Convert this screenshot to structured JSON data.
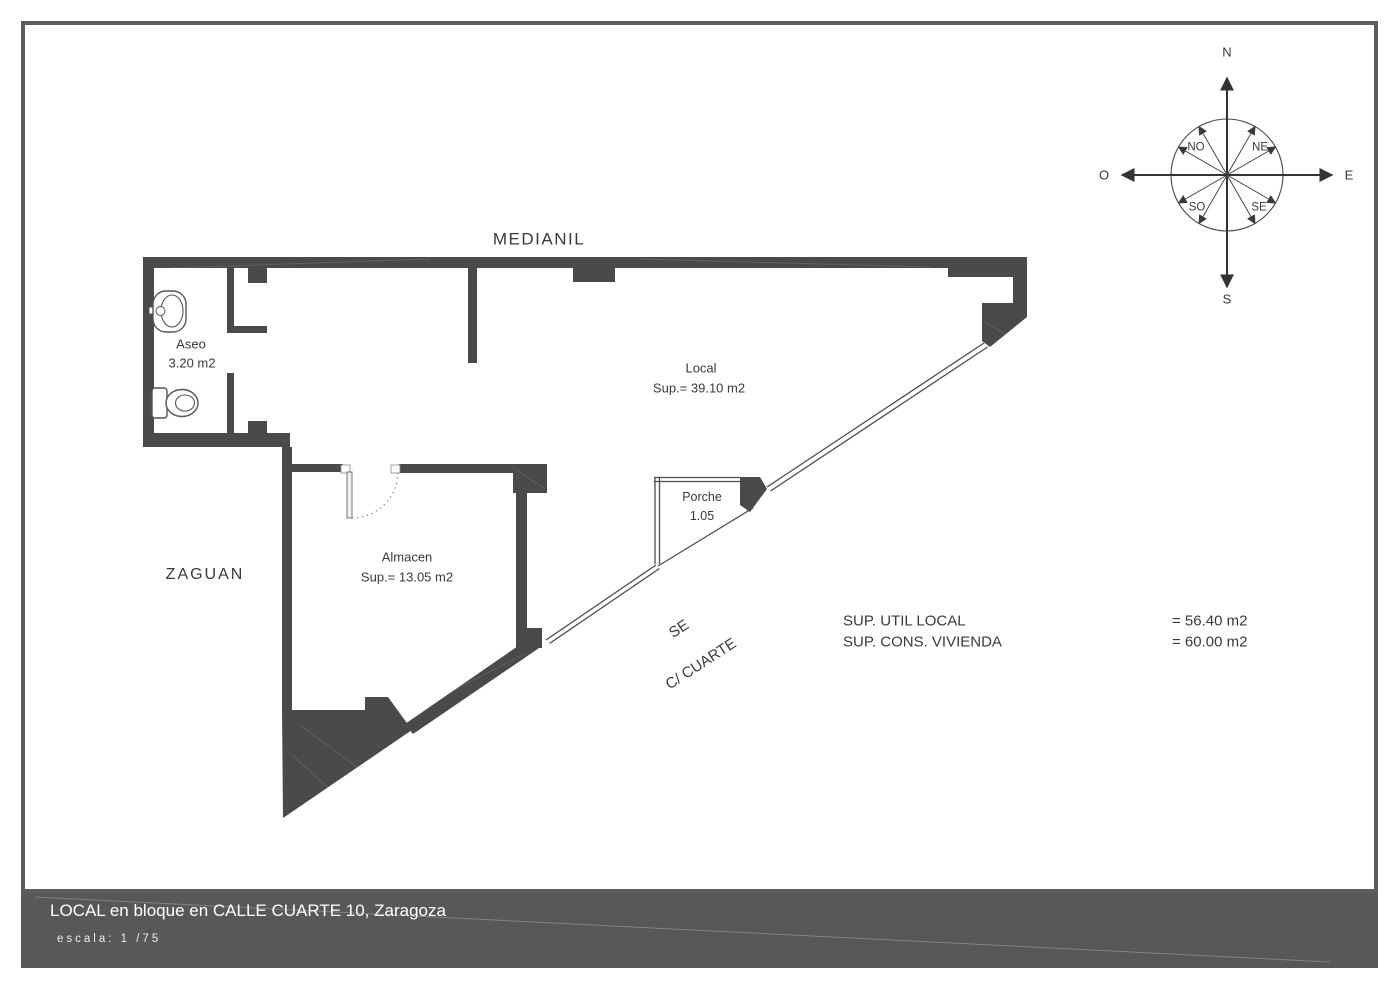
{
  "plan": {
    "boundary_label": "MEDIANIL",
    "adjacent_space": "ZAGUAN",
    "rooms": {
      "aseo": {
        "name": "Aseo",
        "area": "3.20 m2"
      },
      "local": {
        "name": "Local",
        "area": "Sup.= 39.10 m2"
      },
      "almacen": {
        "name": "Almacen",
        "area": "Sup.= 13.05 m2"
      },
      "porche": {
        "name": "Porche",
        "area": "1.05"
      }
    },
    "street": {
      "orientation": "SE",
      "name": "C/ CUARTE"
    }
  },
  "compass": {
    "north": "N",
    "south": "S",
    "east": "E",
    "west": "O",
    "northeast": "NE",
    "northwest": "NO",
    "southeast": "SE",
    "southwest": "SO"
  },
  "summary": {
    "rows": [
      {
        "label": "SUP. UTIL LOCAL",
        "value": "= 56.40 m2"
      },
      {
        "label": "SUP. CONS. VIVIENDA",
        "value": "= 60.00 m2"
      }
    ]
  },
  "titleblock": {
    "title": "LOCAL en bloque en CALLE CUARTE 10, Zaragoza",
    "scale": "escala: 1 /75"
  },
  "colors": {
    "wall": "#4a4a4a",
    "titleband": "#585858",
    "frame": "#5c5c5c",
    "label_text": "#3a3a3a",
    "title_text": "#ffffff"
  }
}
